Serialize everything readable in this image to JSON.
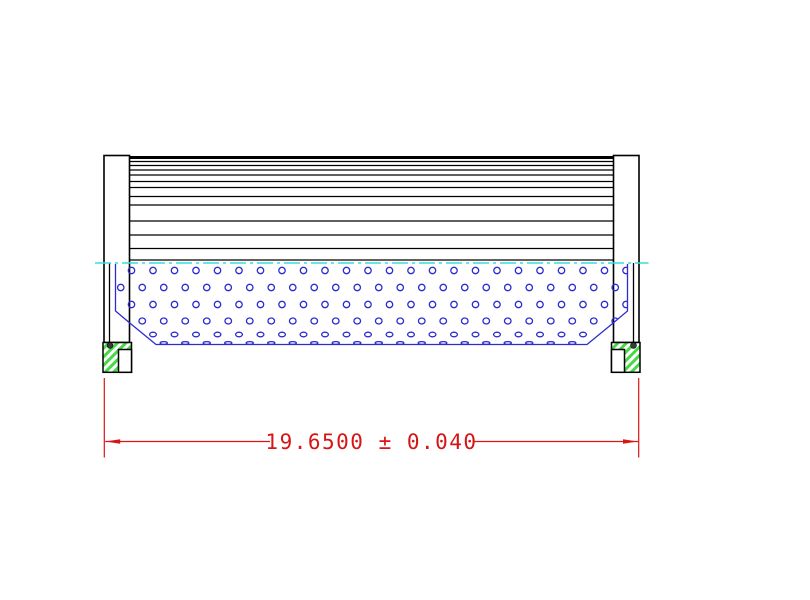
{
  "drawing": {
    "type": "cad-filter-element-section",
    "dimension": {
      "label": "19.6500 ± 0.040",
      "value": "19.6500",
      "plus_minus": "±",
      "tolerance": "0.040"
    },
    "colors": {
      "background": "#ffffff",
      "outline": "#000000",
      "core_blue": "#2c2cd0",
      "centerline_cyan": "#35dede",
      "seal_green": "#46d946",
      "dimension_red": "#d81414",
      "oring_dark": "#3a3a3a"
    },
    "geometry": {
      "pleats": {
        "x1": 129.5,
        "x2": 613.5,
        "top_thick_y": 157.5,
        "top_thick_width": 3,
        "line_ys": [
          161.5,
          165.5,
          170,
          175,
          181.5,
          187.5,
          196.5,
          205,
          221,
          235,
          248.5,
          260
        ]
      },
      "centerline": {
        "y": 263,
        "x1": 95,
        "x2": 648.5,
        "dash": "16 4 3 4"
      },
      "core_outline_points": "115.5,264 115.5,311 131,324 156,344.5 587,344.5 612,324 627.5,311 627.5,264",
      "perforations": {
        "step": 21.5,
        "startA": 131.5,
        "startB": 120.75,
        "xMin": 108,
        "xMax": 636,
        "rows": [
          {
            "y": 270.5,
            "offset": "A",
            "rx": 3.2,
            "ry": 3.2
          },
          {
            "y": 287.5,
            "offset": "B",
            "rx": 3.2,
            "ry": 3.2
          },
          {
            "y": 304.5,
            "offset": "A",
            "rx": 3.2,
            "ry": 3.2
          },
          {
            "y": 321.0,
            "offset": "B",
            "rx": 3.3,
            "ry": 3.0
          },
          {
            "y": 334.5,
            "offset": "A",
            "rx": 3.4,
            "ry": 2.3
          },
          {
            "y": 343.0,
            "offset": "B",
            "rx": 3.6,
            "ry": 1.4
          }
        ]
      },
      "dimension_line": {
        "y": 441.5,
        "ext_left_x": 104.3,
        "ext_right_x": 638.7,
        "ext_y1": 378,
        "ext_y2": 457.5,
        "seg_left": [
          105.2,
          270
        ],
        "seg_right": [
          473,
          638
        ],
        "arrow_len": 15,
        "arrow_half": 2.3,
        "text_x": 371.5,
        "text_y": 449
      }
    }
  }
}
